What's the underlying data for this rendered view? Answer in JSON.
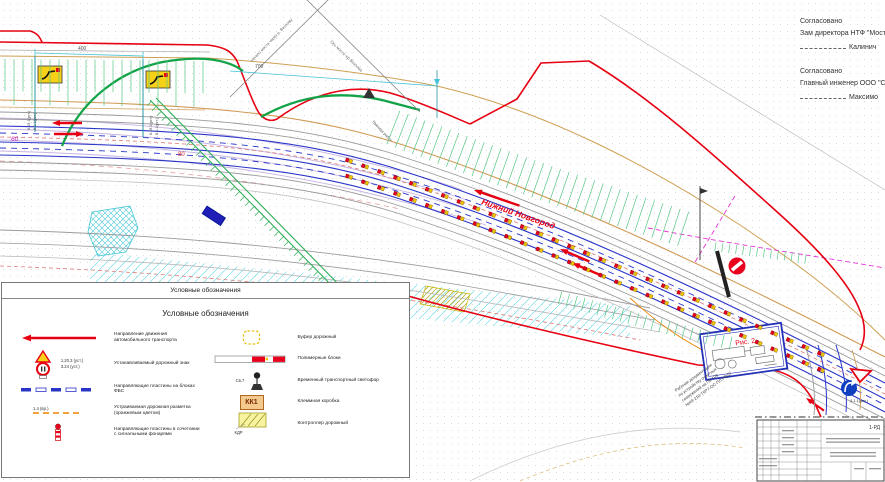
{
  "approvals": [
    {
      "approved_label": "Согласовано",
      "role_line": "Зам директора НТФ \"Мостоо",
      "sign_line": "Калинич"
    },
    {
      "approved_label": "Согласовано",
      "role_line": "Главный инженер ООО \"Стр",
      "sign_line": "Максимо"
    }
  ],
  "legend": {
    "box_title": "Условные обозначения",
    "section_title": "Условные обозначения",
    "left_items": [
      {
        "icon": "direction-arrow",
        "label": "Направление движения автомобильного транспорта"
      },
      {
        "icon": "road-signs",
        "code1": "1.20.3 (уст.)",
        "code2": "3.24 (уст.)",
        "label": "Устанавливаемый дорожный знак"
      },
      {
        "icon": "guide-plates",
        "label": "Направляющие пластины на блоках ФБС"
      },
      {
        "icon": "orange-marking",
        "code": "1.4 (вр.)",
        "label": "Устраиваемая дорожная разметка (оранжевым цветом)"
      },
      {
        "icon": "plate-with-lamp",
        "label": "Направляющие пластины в сочетании с сигнальными фонарями"
      }
    ],
    "right_items": [
      {
        "icon": "road-buffer",
        "label": "Буфер дорожный"
      },
      {
        "icon": "polymer-blocks",
        "label": "Полимерные блоки"
      },
      {
        "icon": "temp-traffic-light",
        "code": "Св.7",
        "label": "Временный транспортный светофор"
      },
      {
        "icon": "terminal-box",
        "code": "КК1",
        "label": "Клеммная коробка"
      },
      {
        "icon": "road-controller",
        "code": "КДР",
        "label": "Контроллер дорожный"
      }
    ]
  },
  "plan": {
    "city_direction": "Нижний Новгород",
    "dim_400": "400",
    "dim_700": "700",
    "speed_limit_60": "60",
    "speed_limit_80": "80",
    "post_codes_a": "6.19.1(уст.)",
    "post_codes_b": "8.1.1(уст.)",
    "blue_sign_code": "4.1.1(уст.)",
    "figure_caption": "Рис. 2",
    "axis_label_start": "начало моста через р. Везлому",
    "axis_label_axis": "Ось моста ч/р Везлома",
    "axis_label_border": "Граница работ",
    "note_lines": [
      "Рабочая документация",
      "по устройству очистных",
      "сооружений на ПК 109",
      "№49-210-ТКР7-ОС-ПЛ.РОД7"
    ],
    "stamp_code": "1-РД"
  },
  "colors": {
    "work_zone_red": "#e60012",
    "bridge_green": "#12a348",
    "lane_blue": "#2a35c8",
    "hatch_green": "#57c785",
    "edge_tan": "#cfa055",
    "hatch_cyan": "#49c8d8",
    "magenta": "#e335d5",
    "plate_red": "#e8001d",
    "plate_yellow": "#f2c500"
  }
}
